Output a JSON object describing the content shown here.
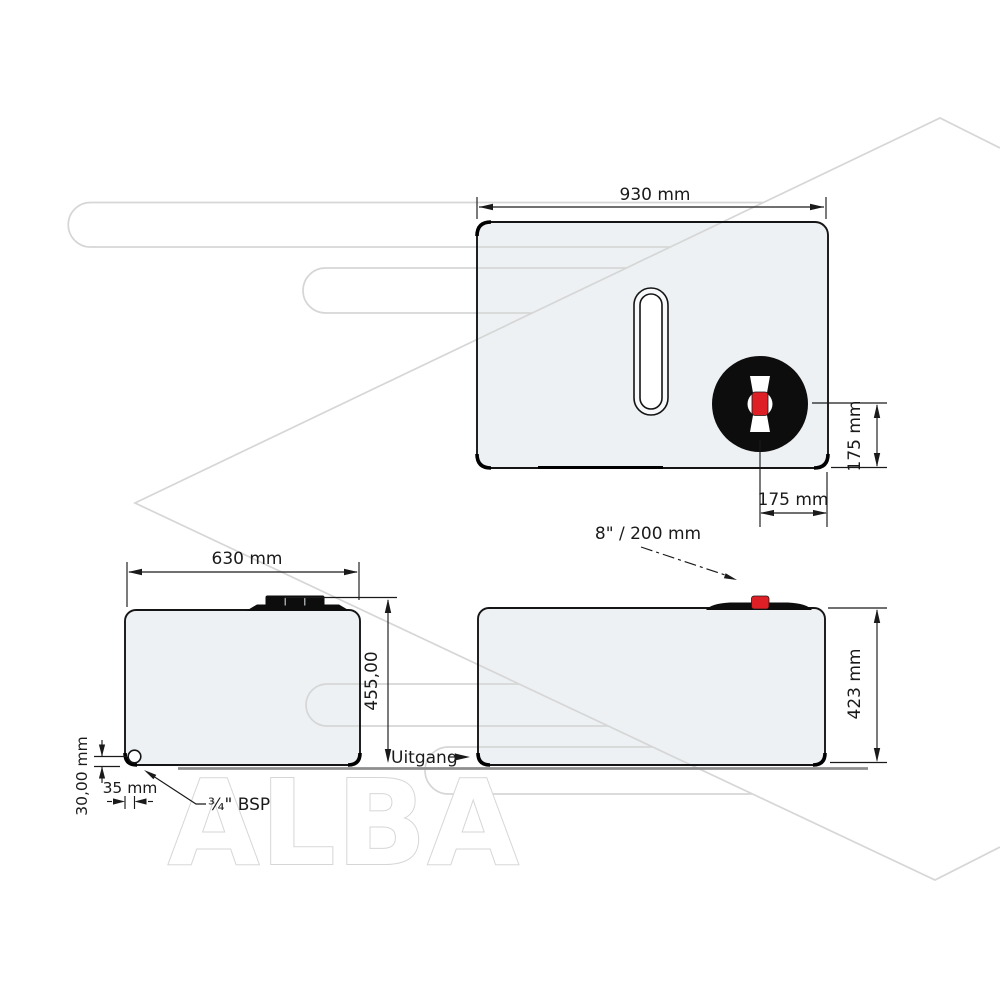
{
  "page": {
    "background": "#ffffff"
  },
  "colors": {
    "line": "#1a1a1a",
    "accent_red": "#de2026",
    "tank_fill": "#edf1f4",
    "watermark": "#d6d6d6",
    "ground": "#8e8e8e"
  },
  "watermark": {
    "brand": "ALBA"
  },
  "top_view": {
    "width_label": "930 mm",
    "lid_offset_vertical_label": "175 mm",
    "lid_offset_horizontal_label": "175 mm",
    "lid_spec_label": "8\" / 200 mm"
  },
  "front_view": {
    "width_label": "630 mm",
    "height_label": "455,00",
    "outlet_label": "Uitgang",
    "outlet_height_label": "30,00 mm",
    "outlet_inset_label": "35 mm",
    "outlet_thread_label": "¾\" BSP"
  },
  "side_view": {
    "height_label": "423 mm"
  }
}
